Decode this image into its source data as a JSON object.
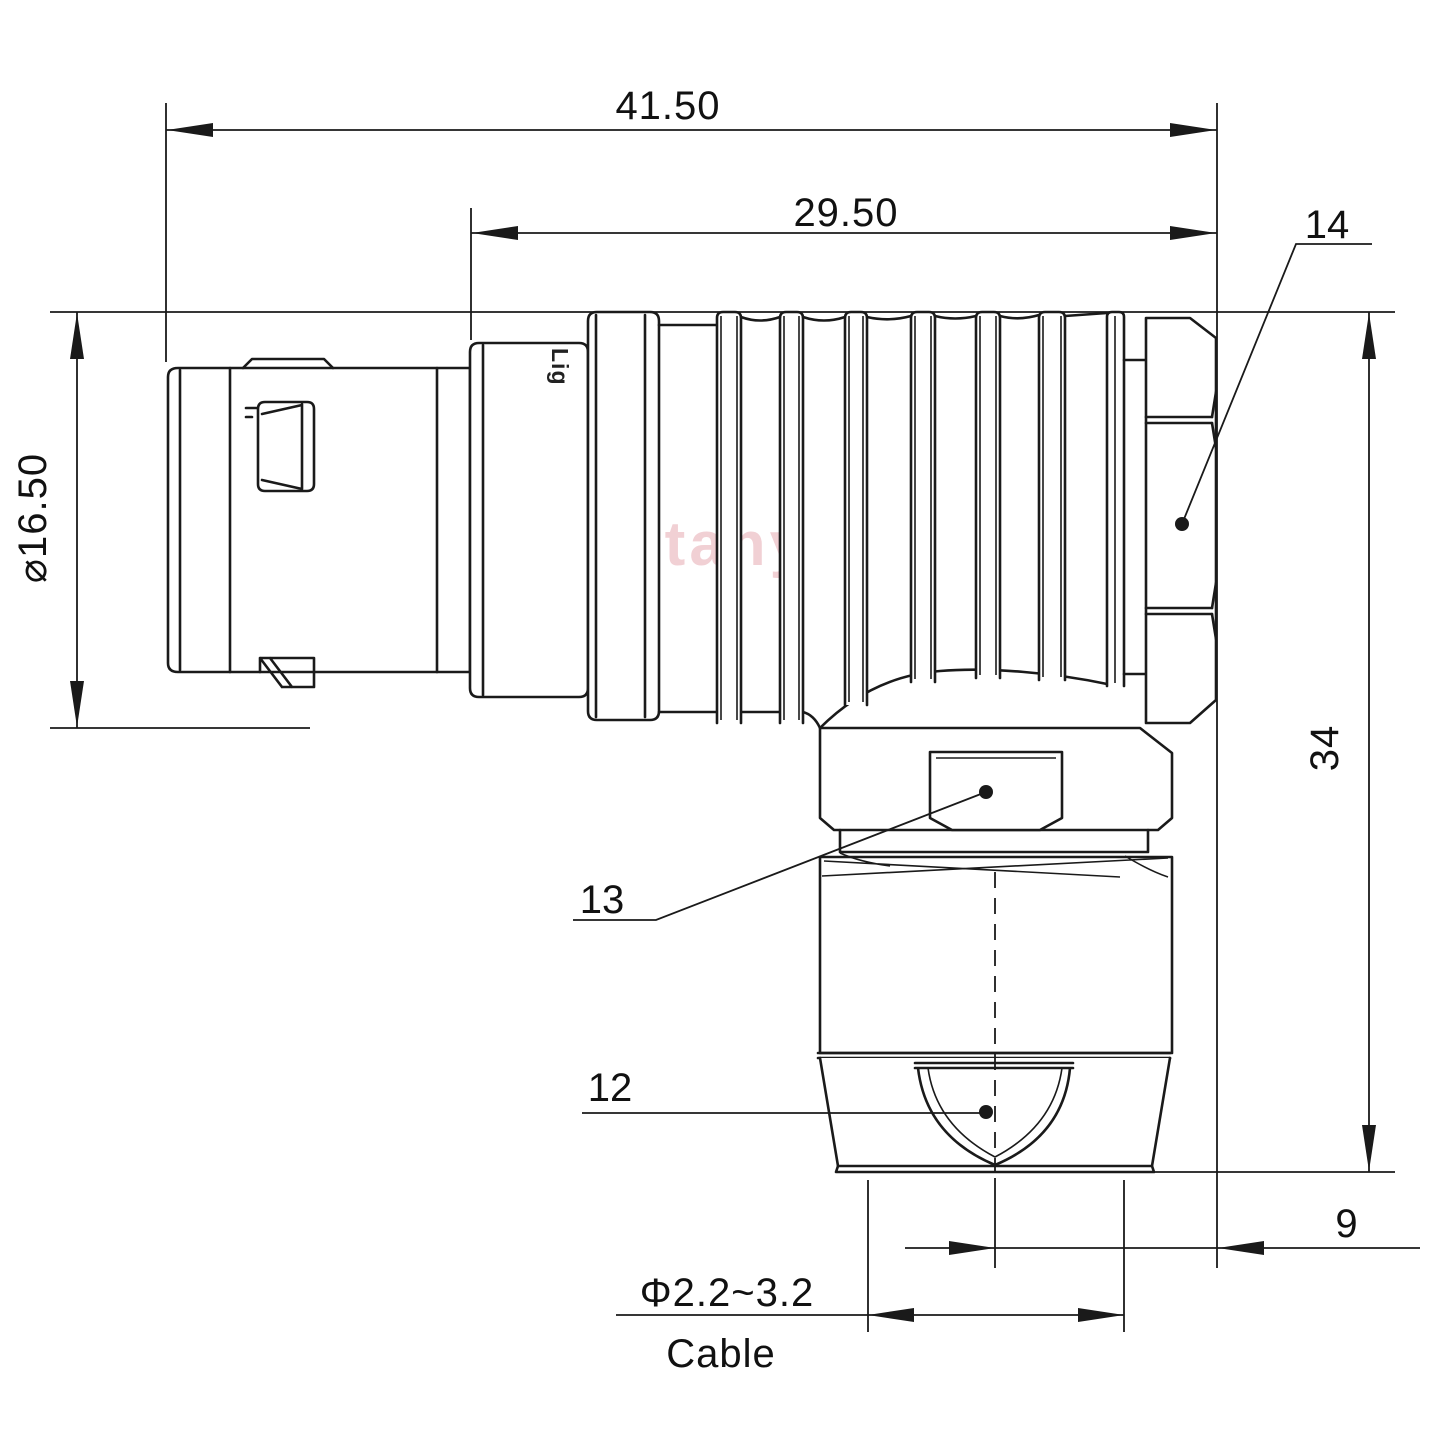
{
  "drawing": {
    "watermark": "Lightany",
    "engraving": "Lig",
    "line_color": "#1a1a1a",
    "watermark_color": "#e0909b",
    "dimensions": {
      "overall_length": "41.50",
      "front_length": "29.50",
      "shell_diameter": "⌀16.50",
      "overall_height": "34",
      "elbow_offset": "9",
      "cable_diameter": "Φ2.2~3.2",
      "cable_label": "Cable"
    },
    "part_labels": {
      "coupling_nut": "14",
      "body_hex": "13",
      "cable_clamp_nut": "12"
    }
  }
}
